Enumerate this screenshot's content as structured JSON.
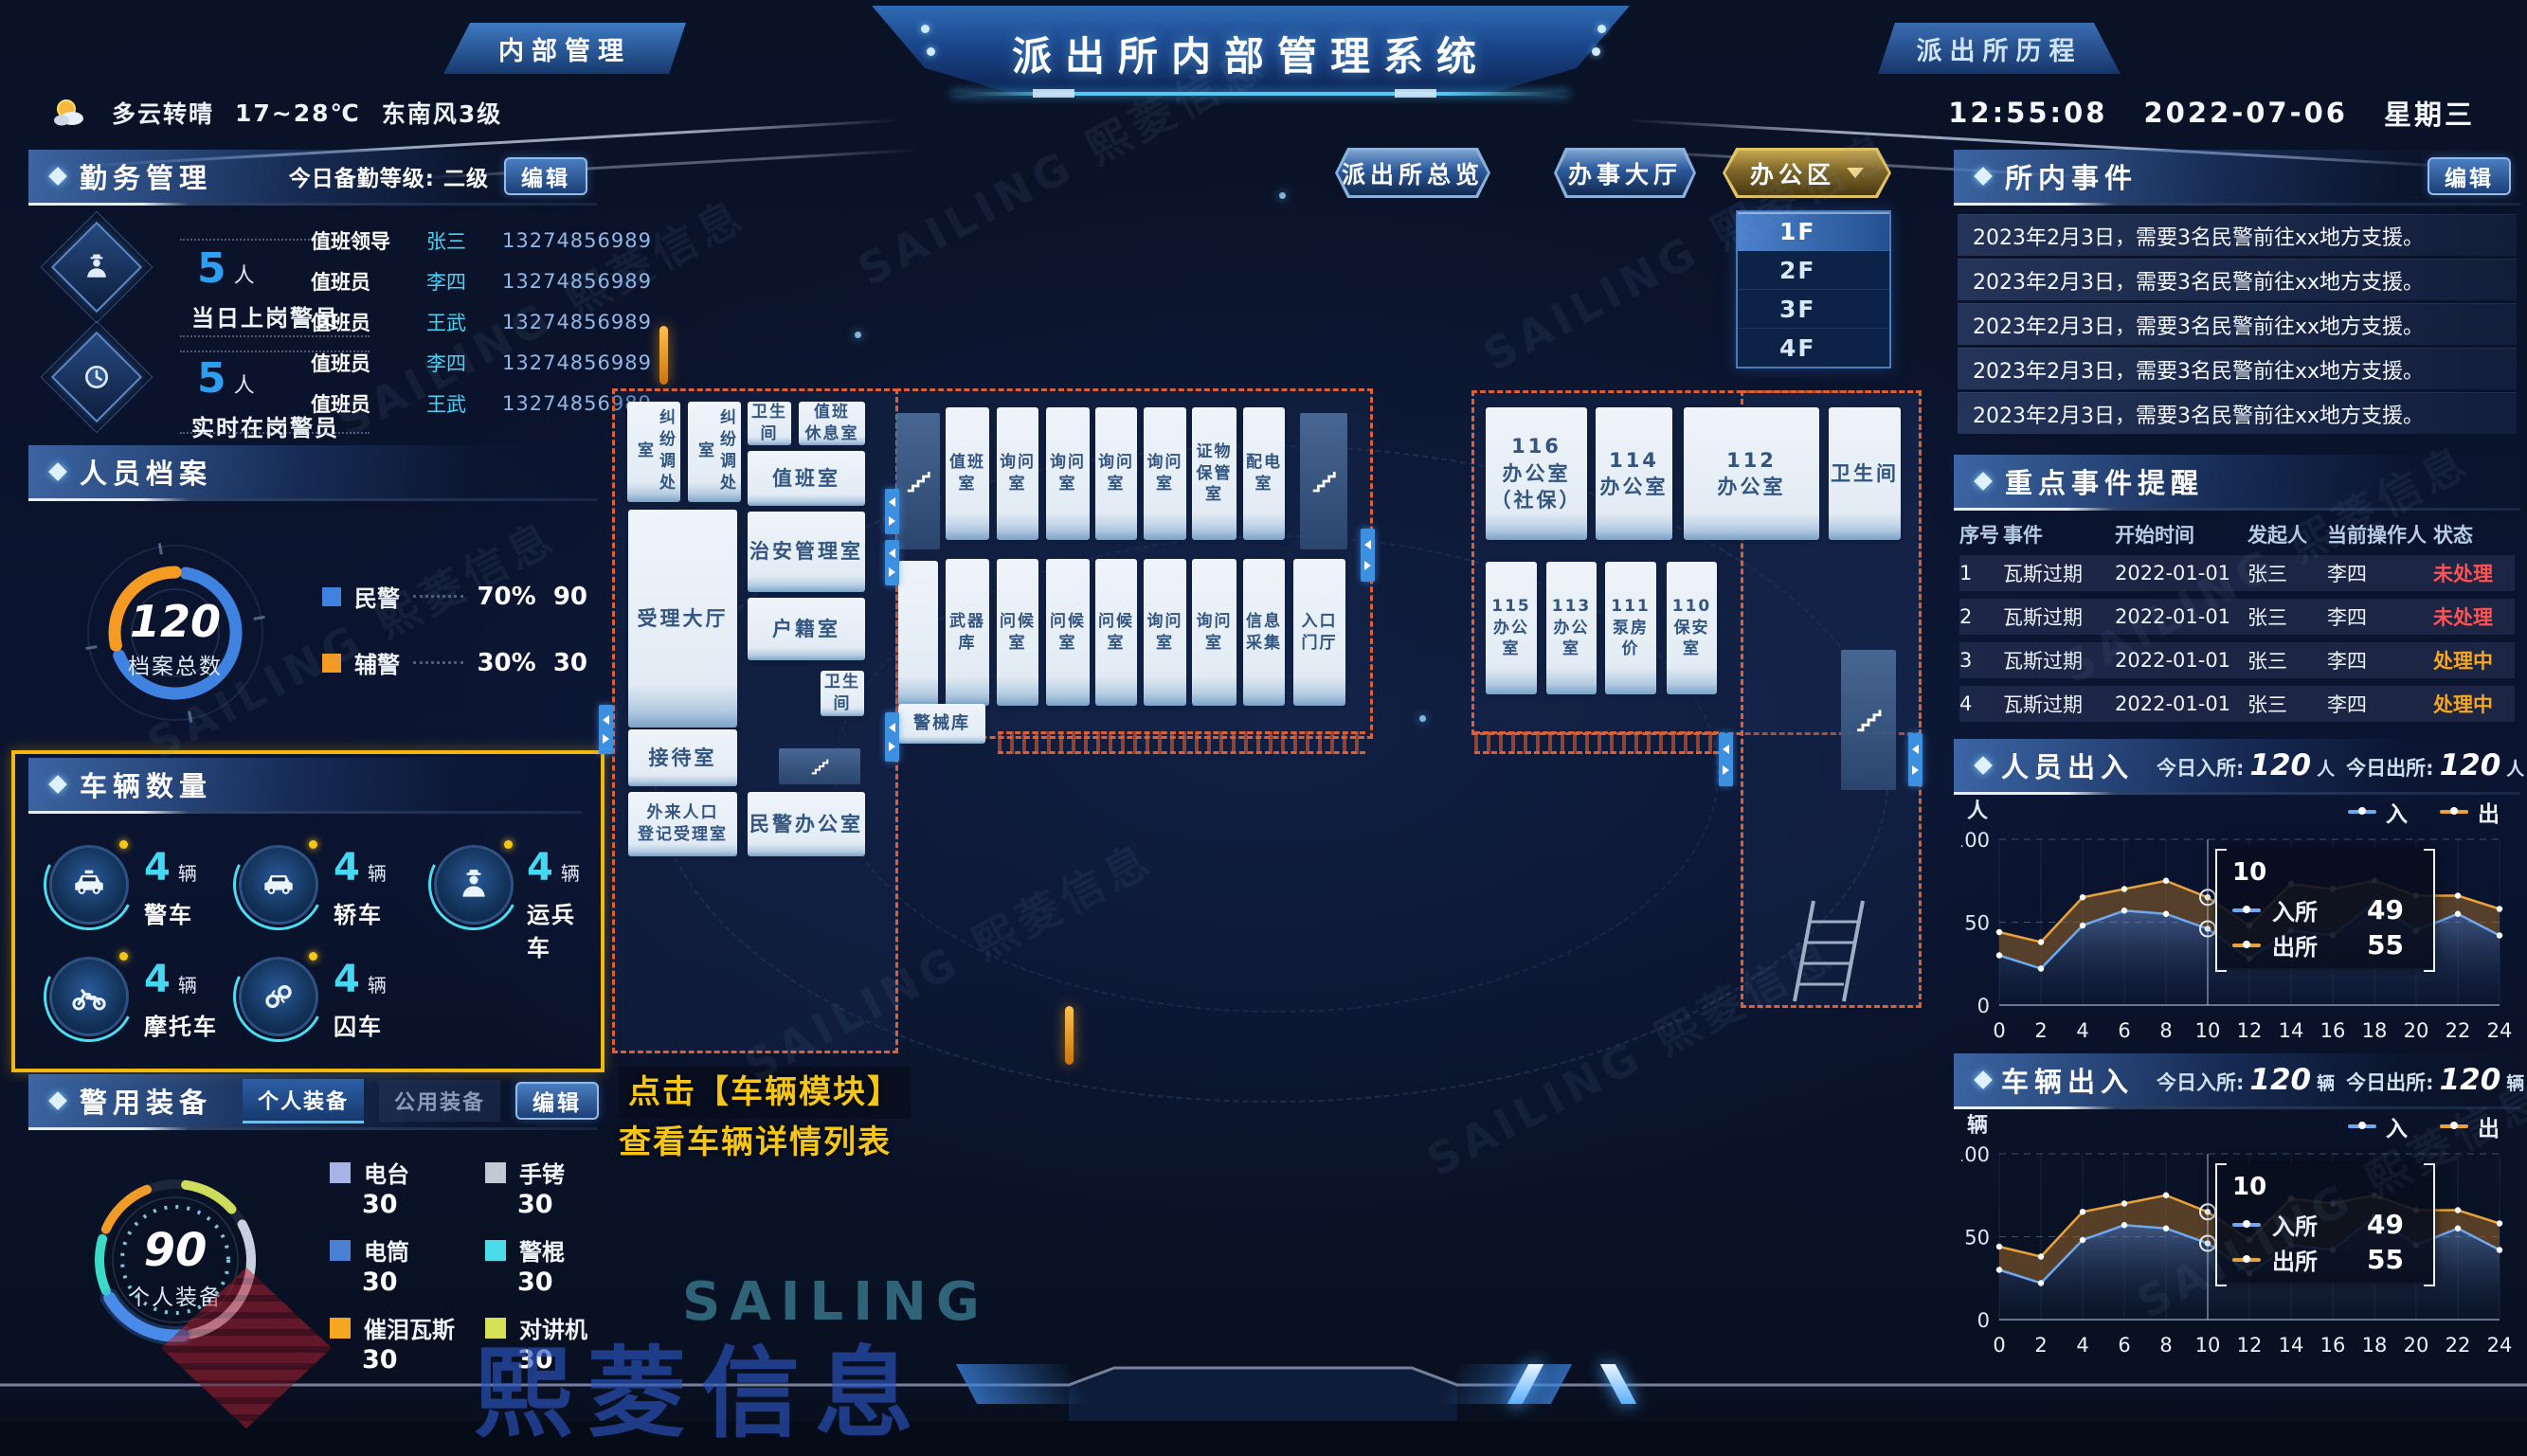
{
  "header": {
    "left_tab": "内部管理",
    "title": "派出所内部管理系统",
    "right_tab": "派出所历程",
    "weather": {
      "condition": "多云转晴",
      "temp": "17~28℃",
      "wind": "东南风3级"
    },
    "clock": {
      "time": "12:55:08",
      "date": "2022-07-06",
      "weekday": "星期三"
    }
  },
  "duty": {
    "title": "勤务管理",
    "level": "今日备勤等级: 二级",
    "edit": "编辑",
    "stats": [
      {
        "value": "5",
        "unit": "人",
        "label": "当日上岗警员"
      },
      {
        "value": "5",
        "unit": "人",
        "label": "实时在岗警员"
      }
    ],
    "roster": [
      {
        "role": "值班领导",
        "name": "张三",
        "phone": "13274856989"
      },
      {
        "role": "值班员",
        "name": "李四",
        "phone": "13274856989"
      },
      {
        "role": "值班员",
        "name": "王武",
        "phone": "13274856989"
      },
      {
        "role": "值班员",
        "name": "李四",
        "phone": "13274856989"
      },
      {
        "role": "值班员",
        "name": "王武",
        "phone": "13274856989"
      }
    ]
  },
  "personnel": {
    "title": "人员档案",
    "total": "120",
    "total_label": "档案总数",
    "legend": [
      {
        "label": "民警",
        "pct": "70%",
        "count": "90",
        "color": "#3f82e0",
        "value": 70
      },
      {
        "label": "辅警",
        "pct": "30%",
        "count": "30",
        "color": "#f59a23",
        "value": 30
      }
    ]
  },
  "vehicles": {
    "title": "车辆数量",
    "highlight_color": "#f0b810",
    "items": [
      {
        "count": "4",
        "unit": "辆",
        "label": "警车"
      },
      {
        "count": "4",
        "unit": "辆",
        "label": "轿车"
      },
      {
        "count": "4",
        "unit": "辆",
        "label": "运兵车"
      },
      {
        "count": "4",
        "unit": "辆",
        "label": "摩托车"
      },
      {
        "count": "4",
        "unit": "辆",
        "label": "囚车"
      }
    ]
  },
  "equipment": {
    "title": "警用装备",
    "tabs": [
      "个人装备",
      "公用装备"
    ],
    "edit": "编辑",
    "total": "90",
    "total_label": "个人装备",
    "items": [
      {
        "label": "电台",
        "count": "30",
        "color": "#a8b4e8"
      },
      {
        "label": "手铐",
        "count": "30",
        "color": "#c2c8d4"
      },
      {
        "label": "电筒",
        "count": "30",
        "color": "#4a7fd4"
      },
      {
        "label": "警棍",
        "count": "30",
        "color": "#4adce8"
      },
      {
        "label": "催泪瓦斯",
        "count": "30",
        "color": "#f5a623"
      },
      {
        "label": "对讲机",
        "count": "30",
        "color": "#d6e157"
      }
    ]
  },
  "map": {
    "view_tabs": [
      "派出所总览",
      "办事大厅",
      "办公区"
    ],
    "floors": [
      "1F",
      "2F",
      "3F",
      "4F"
    ],
    "active_floor": "1F",
    "annotation_line1": "点击【车辆模块】",
    "annotation_line2": "查看车辆详情列表",
    "rooms": [
      "纠纷调处室",
      "纠纷调处室",
      "卫生间",
      "值班\n休息室",
      "值班室",
      "受理大厅",
      "治安管理室",
      "户籍室",
      "卫生间",
      "接待室",
      "外来人口\n登记受理室",
      "民警办公室",
      "值班室",
      "询问室",
      "询问室",
      "询问室",
      "询问室",
      "证物\n保管室",
      "配电室",
      "武器库",
      "问候室",
      "问候室",
      "问候室",
      "询问室",
      "询问室",
      "信息采集",
      "入口\n门厅",
      "警械库",
      "116\n办公室\n（社保）",
      "114\n办公室",
      "112\n办公室",
      "卫生间",
      "115\n办公\n室",
      "113\n办公\n室",
      "111\n泵房\n价",
      "110\n保安\n室"
    ]
  },
  "events": {
    "title": "所内事件",
    "edit": "编辑",
    "items": [
      "2023年2月3日，需要3名民警前往xx地方支援。",
      "2023年2月3日，需要3名民警前往xx地方支援。",
      "2023年2月3日，需要3名民警前往xx地方支援。",
      "2023年2月3日，需要3名民警前往xx地方支援。",
      "2023年2月3日，需要3名民警前往xx地方支援。"
    ]
  },
  "key_events": {
    "title": "重点事件提醒",
    "columns": [
      "序号",
      "事件",
      "开始时间",
      "发起人",
      "当前操作人",
      "状态"
    ],
    "rows": [
      {
        "no": "1",
        "event": "瓦斯过期",
        "start": "2022-01-01",
        "by": "张三",
        "op": "李四",
        "status": "未处理",
        "status_color": "#ff5252"
      },
      {
        "no": "2",
        "event": "瓦斯过期",
        "start": "2022-01-01",
        "by": "张三",
        "op": "李四",
        "status": "未处理",
        "status_color": "#ff5252"
      },
      {
        "no": "3",
        "event": "瓦斯过期",
        "start": "2022-01-01",
        "by": "张三",
        "op": "李四",
        "status": "处理中",
        "status_color": "#f5a623"
      },
      {
        "no": "4",
        "event": "瓦斯过期",
        "start": "2022-01-01",
        "by": "张三",
        "op": "李四",
        "status": "处理中",
        "status_color": "#f5a623"
      }
    ]
  },
  "people_flow": {
    "title": "人员出入",
    "in_label": "今日入所:",
    "in_value": "120",
    "in_unit": "人",
    "out_label": "今日出所:",
    "out_value": "120",
    "out_unit": "人",
    "axis_unit": "人"
  },
  "vehicle_flow": {
    "title": "车辆出入",
    "in_label": "今日入所:",
    "in_value": "120",
    "in_unit": "辆",
    "out_label": "今日出所:",
    "out_value": "120",
    "out_unit": "辆",
    "axis_unit": "辆"
  },
  "chart_data": [
    {
      "type": "area",
      "title": "人员出入(24小时)",
      "x": [
        0,
        2,
        4,
        6,
        8,
        10,
        12,
        14,
        16,
        18,
        20,
        22,
        24
      ],
      "series": [
        {
          "name": "入",
          "color": "#6fa8f0",
          "values": [
            30,
            22,
            48,
            57,
            55,
            46,
            28,
            45,
            42,
            62,
            45,
            55,
            42
          ]
        },
        {
          "name": "出",
          "color": "#e8a23c",
          "values": [
            44,
            38,
            65,
            70,
            75,
            65,
            48,
            73,
            70,
            75,
            66,
            66,
            58
          ]
        }
      ],
      "ylim": [
        0,
        100
      ],
      "yticks": [
        0,
        50,
        100
      ],
      "grid": true,
      "legend_position": "top-right",
      "tooltip": {
        "x": "10",
        "index": 5,
        "rows": [
          {
            "label": "入所",
            "value": "49"
          },
          {
            "label": "出所",
            "value": "55"
          }
        ]
      }
    },
    {
      "type": "area",
      "title": "车辆出入(24小时)",
      "x": [
        0,
        2,
        4,
        6,
        8,
        10,
        12,
        14,
        16,
        18,
        20,
        22,
        24
      ],
      "series": [
        {
          "name": "入",
          "color": "#6fa8f0",
          "values": [
            30,
            22,
            48,
            57,
            55,
            46,
            28,
            45,
            42,
            62,
            45,
            55,
            42
          ]
        },
        {
          "name": "出",
          "color": "#e8a23c",
          "values": [
            44,
            38,
            65,
            70,
            75,
            65,
            48,
            73,
            70,
            75,
            66,
            66,
            58
          ]
        }
      ],
      "ylim": [
        0,
        100
      ],
      "yticks": [
        0,
        50,
        100
      ],
      "grid": true,
      "legend_position": "top-right",
      "tooltip": {
        "x": "10",
        "index": 5,
        "rows": [
          {
            "label": "入所",
            "value": "49"
          },
          {
            "label": "出所",
            "value": "55"
          }
        ]
      }
    }
  ],
  "watermark": {
    "brand": "SAILING",
    "company": "熙菱信息",
    "text": "SAILING 熙菱信息"
  }
}
